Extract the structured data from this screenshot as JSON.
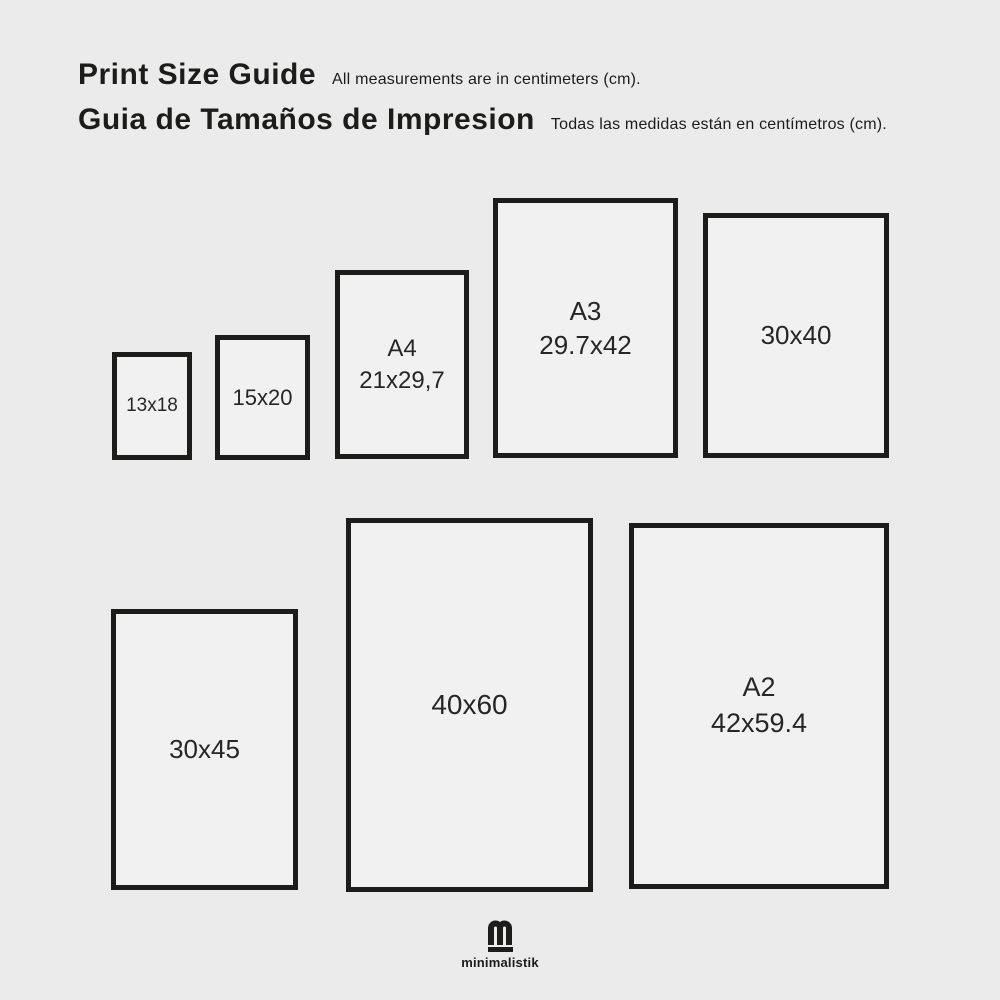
{
  "page": {
    "colors": {
      "background": "#ebebeb",
      "box_fill": "#f1f1f1",
      "ink": "#1c1c1a",
      "label": "#262626"
    }
  },
  "header": {
    "title_en": "Print Size Guide",
    "subtitle_en": "All measurements are in centimeters (cm).",
    "title_es": "Guia de Tamaños de Impresion",
    "subtitle_es": "Todas las medidas están en centímetros (cm)."
  },
  "sizes": [
    {
      "name": "",
      "dimensions": "13x18"
    },
    {
      "name": "",
      "dimensions": "15x20"
    },
    {
      "name": "A4",
      "dimensions": "21x29,7"
    },
    {
      "name": "A3",
      "dimensions": "29.7x42"
    },
    {
      "name": "",
      "dimensions": "30x40"
    },
    {
      "name": "",
      "dimensions": "30x45"
    },
    {
      "name": "",
      "dimensions": "40x60"
    },
    {
      "name": "A2",
      "dimensions": "42x59.4"
    }
  ],
  "footer": {
    "logo_icon": "minimalistik-m",
    "brand": "minimalistik"
  }
}
